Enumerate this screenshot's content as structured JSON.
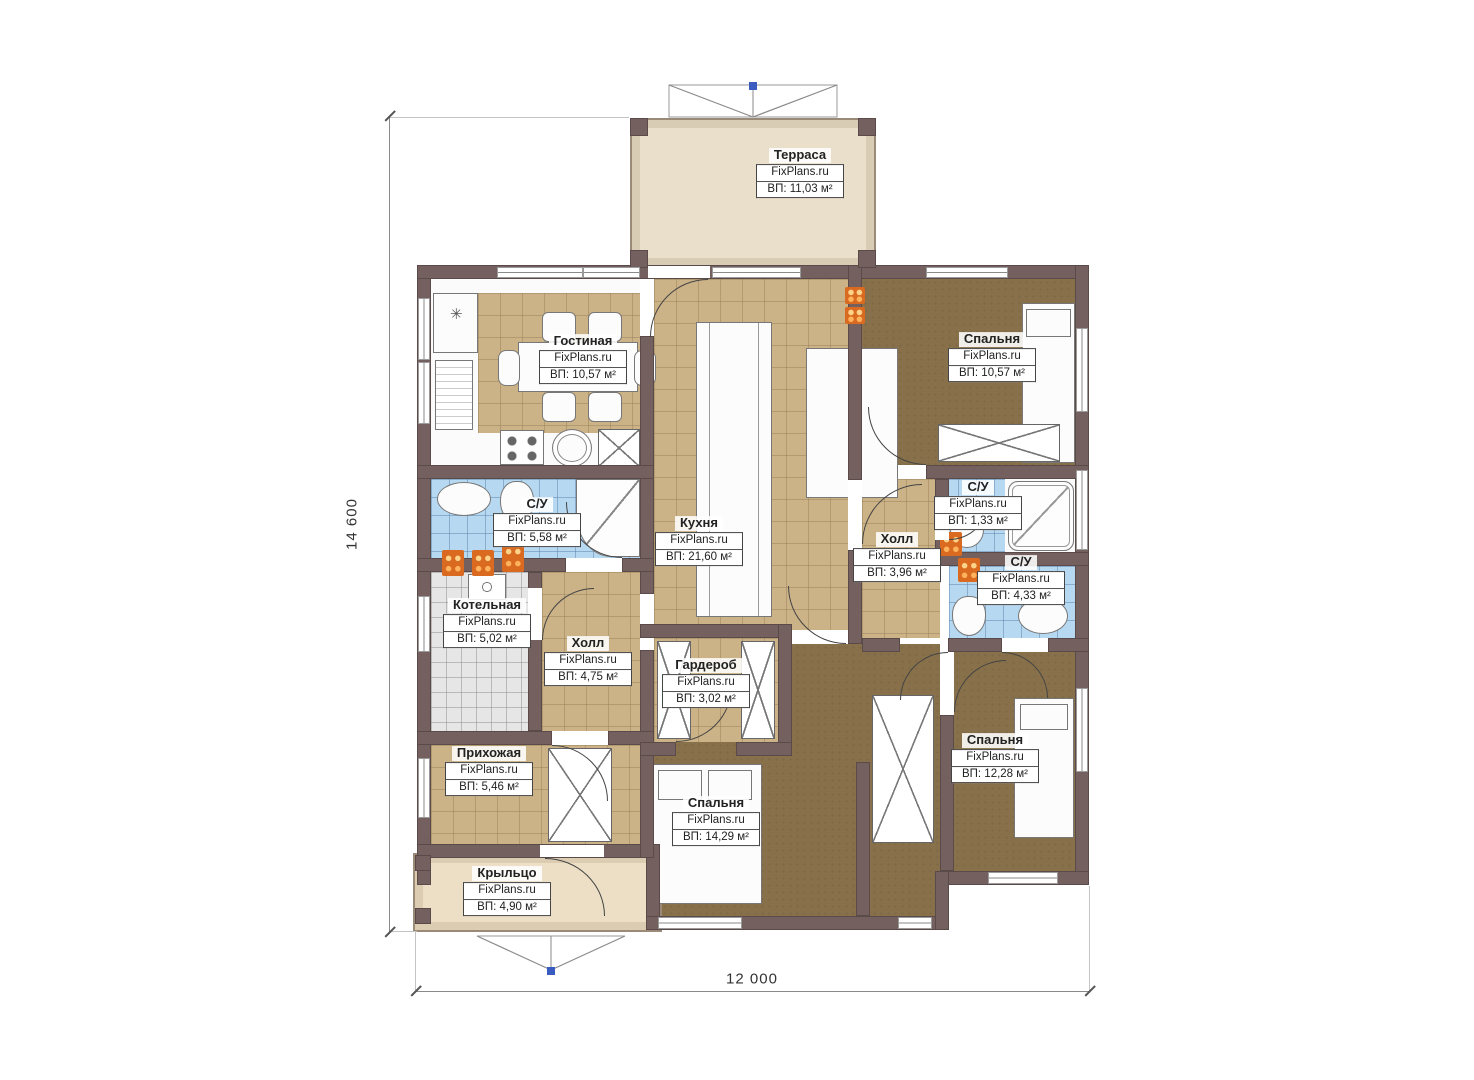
{
  "brand": "FixPlans.ru",
  "dimensions": {
    "height": "14 600",
    "width": "12 000"
  },
  "rooms": [
    {
      "name": "Терраса",
      "area": "ВП: 11,03 м²"
    },
    {
      "name": "Гостиная",
      "area": "ВП: 10,57 м²"
    },
    {
      "name": "Спальня",
      "area": "ВП: 10,57 м²"
    },
    {
      "name": "С/У",
      "area": "ВП: 5,58 м²"
    },
    {
      "name": "Кухня",
      "area": "ВП: 21,60 м²"
    },
    {
      "name": "Холл",
      "area": "ВП: 3,96 м²"
    },
    {
      "name": "С/У",
      "area": "ВП: 1,33 м²"
    },
    {
      "name": "С/У",
      "area": "ВП: 4,33 м²"
    },
    {
      "name": "Котельная",
      "area": "ВП: 5,02 м²"
    },
    {
      "name": "Холл",
      "area": "ВП: 4,75 м²"
    },
    {
      "name": "Гардероб",
      "area": "ВП: 3,02 м²"
    },
    {
      "name": "Прихожая",
      "area": "ВП: 5,46 м²"
    },
    {
      "name": "Спальня",
      "area": "ВП: 14,29 м²"
    },
    {
      "name": "Спальня",
      "area": "ВП: 12,28 м²"
    },
    {
      "name": "Крыльцо",
      "area": "ВП: 4,90 м²"
    }
  ],
  "colors": {
    "wall": "#73605f",
    "wall_edge": "#5a4a4a",
    "tile_tan": "#cbb287",
    "floor_brown": "#88714a",
    "tile_blue": "#b7d8f1",
    "tile_gray": "#e6e6e6",
    "terrace": "#e9dfca",
    "terrace_edge": "#9a8a77",
    "porch": "#ecdfc6",
    "radiator": "#d96a1f",
    "marker": "#3a5bbf",
    "dim": "#8a8a8a"
  }
}
